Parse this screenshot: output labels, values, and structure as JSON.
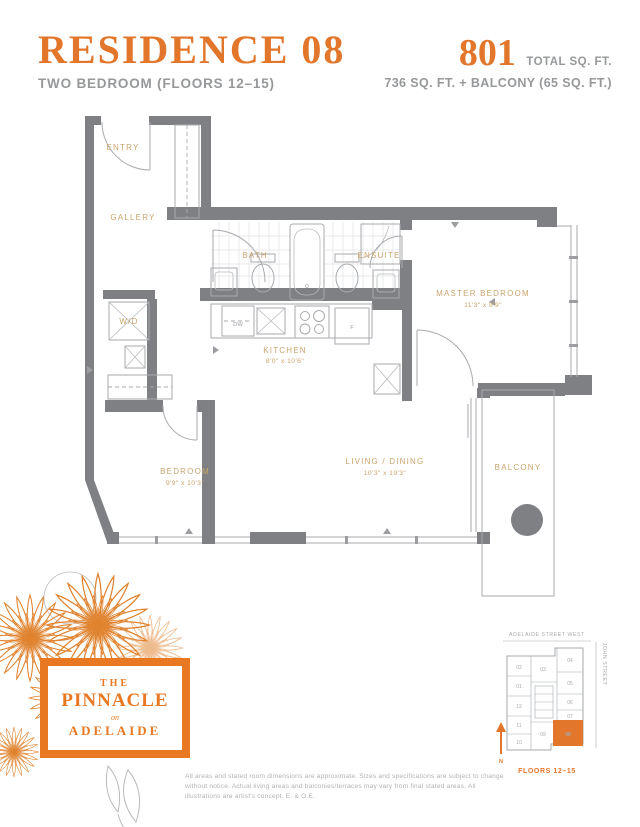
{
  "header": {
    "residence_title": "RESIDENCE 08",
    "residence_subtitle": "TWO BEDROOM (FLOORS 12–15)",
    "area_number": "801",
    "area_unit_label": "TOTAL SQ. FT.",
    "area_breakdown": "736 SQ. FT. + BALCONY (65 SQ. FT.)"
  },
  "rooms": {
    "entry": {
      "label": "ENTRY"
    },
    "gallery": {
      "label": "GALLERY"
    },
    "bath": {
      "label": "BATH"
    },
    "ensuite": {
      "label": "ENSUITE"
    },
    "wd": {
      "label": "W/D"
    },
    "kitchen": {
      "label": "KITCHEN",
      "dims": "8'0\" x 10'6\""
    },
    "master": {
      "label": "MASTER BEDROOM",
      "dims": "11'3\" x 9'9\""
    },
    "bedroom": {
      "label": "BEDROOM",
      "dims": "9'9\" x 10'3\""
    },
    "living": {
      "label": "LIVING / DINING",
      "dims": "10'3\" x 19'3\""
    },
    "balcony": {
      "label": "BALCONY"
    }
  },
  "appliances": {
    "dishwasher": "DW",
    "fridge": "F"
  },
  "logo": {
    "line1": "THE",
    "line2": "PINNACLE",
    "line3": "on",
    "line4": "ADELAIDE"
  },
  "keyplan": {
    "street_top": "ADELAIDE STREET WEST",
    "street_right": "JOHN STREET",
    "floors_label": "FLOORS 12–15",
    "north_label": "N",
    "highlighted_unit": "08",
    "units": {
      "01": "01",
      "02": "02",
      "03": "03",
      "04": "04",
      "05": "05",
      "06": "06",
      "07": "07",
      "08": "08",
      "09": "09",
      "10": "10",
      "11": "11",
      "12": "12"
    }
  },
  "disclaimer": "All areas and stated room dimensions are approximate. Sizes and specifications are subject to change without notice. Actual living areas and balconies/terraces may vary from final stated areas. All illustrations are artist's concept. E. & O.E.",
  "colors": {
    "accent_orange": "#E2762B",
    "logo_orange": "#E87822",
    "wall_gray": "#7E8083",
    "room_label_tan": "#C9A46C",
    "text_gray": "#96989A"
  }
}
